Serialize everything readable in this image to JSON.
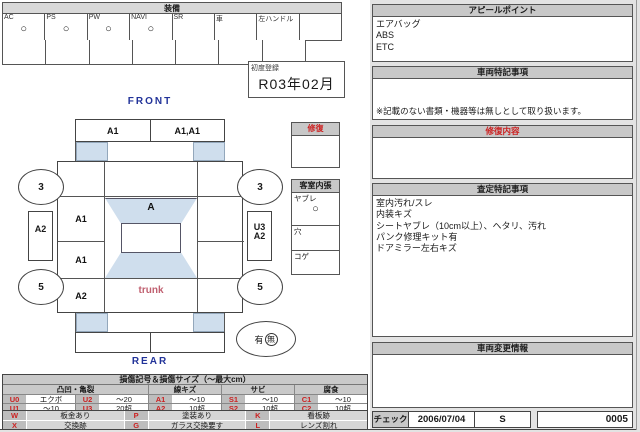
{
  "colors": {
    "accent_red": "#cc2222",
    "navy": "#223399",
    "light_blue": "#cfdeed",
    "header_gray": "#c8c8c8"
  },
  "equipment": {
    "title": "装備",
    "columns": [
      {
        "label": "AC",
        "mark": "○"
      },
      {
        "label": "PS",
        "mark": "○"
      },
      {
        "label": "PW",
        "mark": "○"
      },
      {
        "label": "NAVI",
        "mark": "○"
      },
      {
        "label": "SR",
        "mark": ""
      },
      {
        "label": "車",
        "mark": ""
      },
      {
        "label": "左ハンドル",
        "mark": ""
      },
      {
        "label": "",
        "mark": ""
      }
    ]
  },
  "first_registration": {
    "label": "初度登録",
    "value": "R03年02月"
  },
  "diagram": {
    "front_label": "FRONT",
    "rear_label": "REAR",
    "front_bumper_left": "A1",
    "front_bumper_right": "A1,A1",
    "windshield_mark": "A",
    "left_fender": "A1",
    "left_door": "A1",
    "left_quarter": "A2",
    "left_side_panel": "A2",
    "right_side_top": "U3",
    "right_side_bottom": "A2",
    "trunk": "trunk",
    "wheel_front_left": "3",
    "wheel_front_right": "3",
    "wheel_rear_left": "5",
    "wheel_rear_right": "5",
    "record_prefix": "有",
    "record_circled": "無"
  },
  "repair_box": {
    "title": "修復"
  },
  "cabin_lining": {
    "title": "客室内張",
    "rows": [
      {
        "label": "ヤブレ",
        "mark": "○"
      },
      {
        "label": "穴",
        "mark": ""
      },
      {
        "label": "コゲ",
        "mark": ""
      }
    ]
  },
  "appeal": {
    "title": "アピールポイント",
    "lines": [
      "エアバッグ",
      "ABS",
      "ETC"
    ]
  },
  "vehicle_notes": {
    "title": "車両特記事項",
    "note": "※記載のない書類・機器等は無しとして取り扱います。"
  },
  "repair_content": {
    "title": "修復内容"
  },
  "assessment_notes": {
    "title": "査定特記事項",
    "lines": [
      "室内汚れ/スレ",
      "内装キズ",
      "シートヤブレ（10cm以上）、ヘタリ、汚れ",
      "パンク修理キット有",
      "ドアミラー左右キズ"
    ]
  },
  "vehicle_change": {
    "title": "車両変更情報"
  },
  "check_row": {
    "label": "チェック",
    "date": "2006/07/04",
    "grade": "S",
    "number": "0005"
  },
  "damage_legend": {
    "title": "損傷記号＆損傷サイズ（～最大cm）",
    "groups": [
      "凸凹・亀裂",
      "線キズ",
      "サビ",
      "腐食"
    ],
    "rows": [
      [
        {
          "code": "U0",
          "value": "エクボ"
        },
        {
          "code": "U2",
          "value": "～20"
        },
        {
          "code": "A1",
          "value": "～10"
        },
        {
          "code": "S1",
          "value": "～10"
        },
        {
          "code": "C1",
          "value": "～10"
        }
      ],
      [
        {
          "code": "U1",
          "value": "～10"
        },
        {
          "code": "U3",
          "value": "20超"
        },
        {
          "code": "A2",
          "value": "10超"
        },
        {
          "code": "S2",
          "value": "10超"
        },
        {
          "code": "C2",
          "value": "10超"
        }
      ]
    ],
    "extra_rows": [
      [
        {
          "code": "W",
          "value": "板金あり"
        },
        {
          "code": "P",
          "value": "塗装あり"
        },
        {
          "code": "K",
          "value": "看板跡"
        }
      ],
      [
        {
          "code": "X",
          "value": "交換跡"
        },
        {
          "code": "G",
          "value": "ガラス交換要す"
        },
        {
          "code": "L",
          "value": "レンズ割れ"
        }
      ]
    ]
  }
}
